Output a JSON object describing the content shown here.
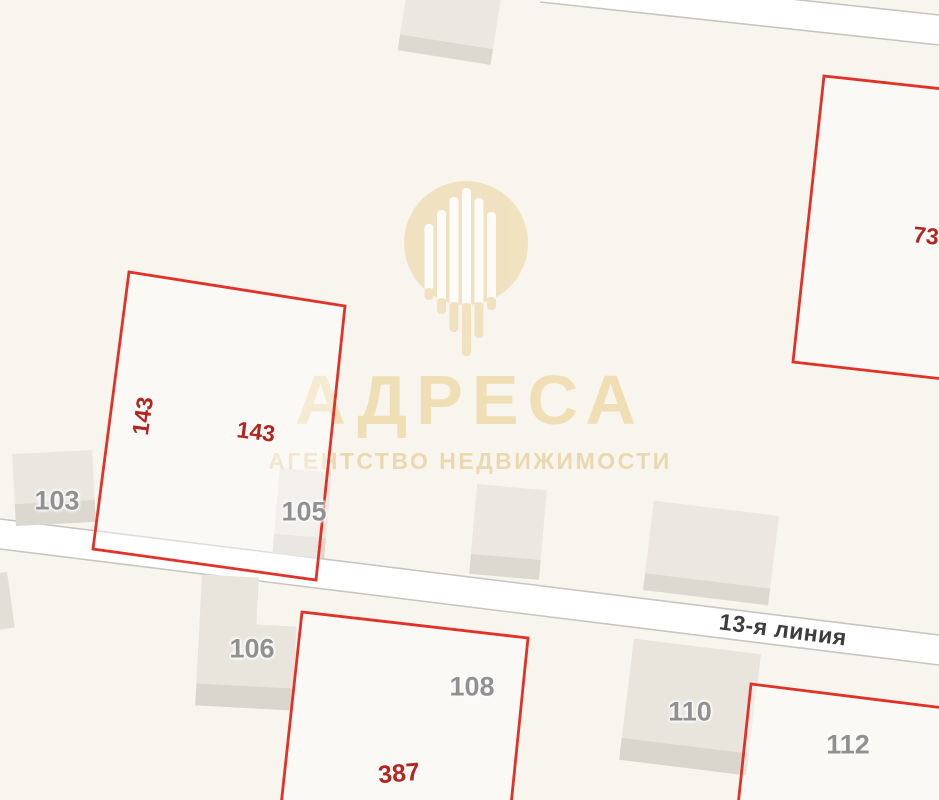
{
  "street": {
    "name": "13-я линия"
  },
  "buildings": [
    {
      "number": "103"
    },
    {
      "number": "105"
    },
    {
      "number": "106"
    },
    {
      "number": "108"
    },
    {
      "number": "110"
    },
    {
      "number": "112"
    }
  ],
  "parcels": [
    {
      "number": "143"
    },
    {
      "number": "143"
    },
    {
      "number": "387"
    },
    {
      "number": "73"
    }
  ],
  "watermark": {
    "brand": "АДРЕСА",
    "tagline": "АГЕНТСТВО НЕДВИЖИМОСТИ"
  },
  "colors": {
    "background": "#f8f5ee",
    "road_fill": "#ffffff",
    "road_border": "#c8c5c0",
    "building_fill": "#ebe7e0",
    "building_base_fill": "#dcd7cf",
    "parcel_outline": "#e23126",
    "building_label": "#919191",
    "parcel_label": "#b5241d",
    "street_label": "#3d3d3d",
    "watermark_gold": "#eed7a8"
  }
}
